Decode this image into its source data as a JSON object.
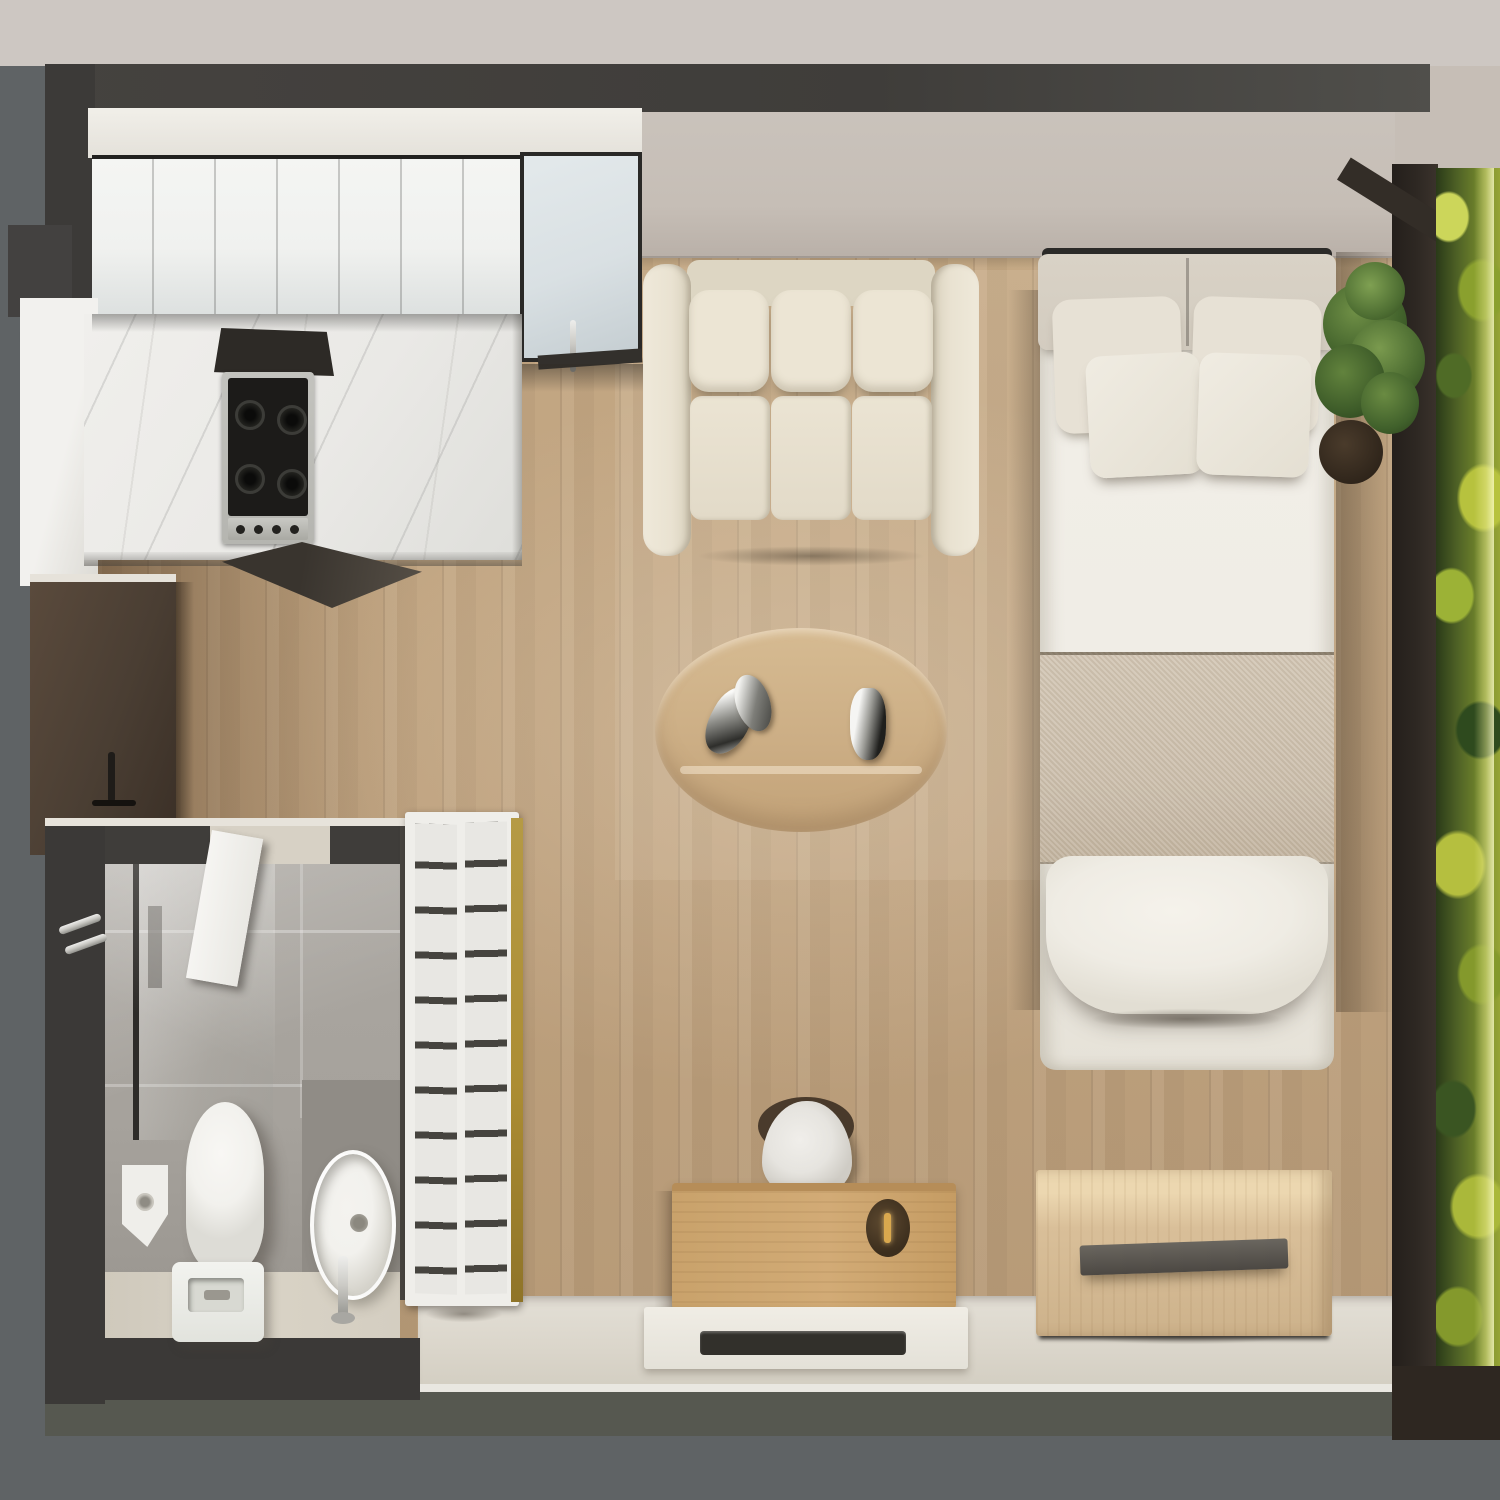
{
  "meta": {
    "kind": "architectural-3d-render",
    "view": "top-down floor plan of a studio apartment",
    "visible_text": "none"
  },
  "palette": {
    "bg_top": "#cdc7c2",
    "bg_outer": "#5f6365",
    "wall": "#3f3d3a",
    "greige": "#c6beb6",
    "wood": "#c4a884",
    "marble": "#eae9e6",
    "cabinet_white": "#f0f1ef",
    "cabinet_blue": "#d9e0e3",
    "stainless": "#b5b5b0",
    "cooktop": "#1c1b19",
    "dark_cabinet": "#4a3e33",
    "sofa": "#e9e2d1",
    "cushion": "#ece5d4",
    "bed_white": "#efece5",
    "headboard": "#d3ccc0",
    "blanket": "#cdc0ae",
    "pillow": "#e7e1d5",
    "table_wood": "#ccae85",
    "desk_wood": "#d2ab76",
    "nightstand": "#d9bf99",
    "shelf_white": "#efeeea",
    "shelf_line": "#46443f",
    "shelf_edge": "#ac8d33",
    "tile": "#a6a29c",
    "tile_dark": "#908c86",
    "bath_floor": "#d9d3c6",
    "fixture": "#f2f1ed",
    "chrome": "#cccbc6",
    "beige_strip": "#dbd6cb",
    "olive_band": "#565850",
    "moss_bright": "#b7c23e",
    "moss_mid": "#84992c",
    "moss_dark": "#2e4a1e",
    "frame": "#2e2823",
    "plant": "#55732f",
    "brass": "#d9a84e"
  },
  "furniture": {
    "upper_cabinets": {
      "label": "Kitchen upper cabinets"
    },
    "tall_cabinet": {
      "label": "Tall kitchen cabinet"
    },
    "countertop": {
      "label": "Marble kitchen countertop"
    },
    "cooktop": {
      "label": "Gas cooktop with 4 burners"
    },
    "dark_cabinet": {
      "label": "Dark wood fridge / storage cabinet"
    },
    "sofa": {
      "label": "Three-seat cream sofa"
    },
    "coffee_table": {
      "label": "Oval wooden coffee table with metal decor"
    },
    "bed": {
      "label": "Bed with headboard, four pillows and beige throw"
    },
    "nightstand": {
      "label": "Wooden dresser with shelf handle"
    },
    "desk": {
      "label": "Wooden desk with chair and lamp"
    },
    "media_bench": {
      "label": "White media bench with soundbar"
    },
    "shelving": {
      "label": "Open wardrobe shelving unit"
    },
    "toilet": {
      "label": "Toilet"
    },
    "sink": {
      "label": "Round washbasin with faucet"
    },
    "shower": {
      "label": "Shower with glass screen"
    },
    "bath_door": {
      "label": "Bathroom door, ajar"
    },
    "moss_wall": {
      "label": "Vertical moss garden wall"
    },
    "plant": {
      "label": "Potted green plant"
    }
  },
  "shelving": {
    "columns": 2,
    "shelves_per_column": 11
  }
}
